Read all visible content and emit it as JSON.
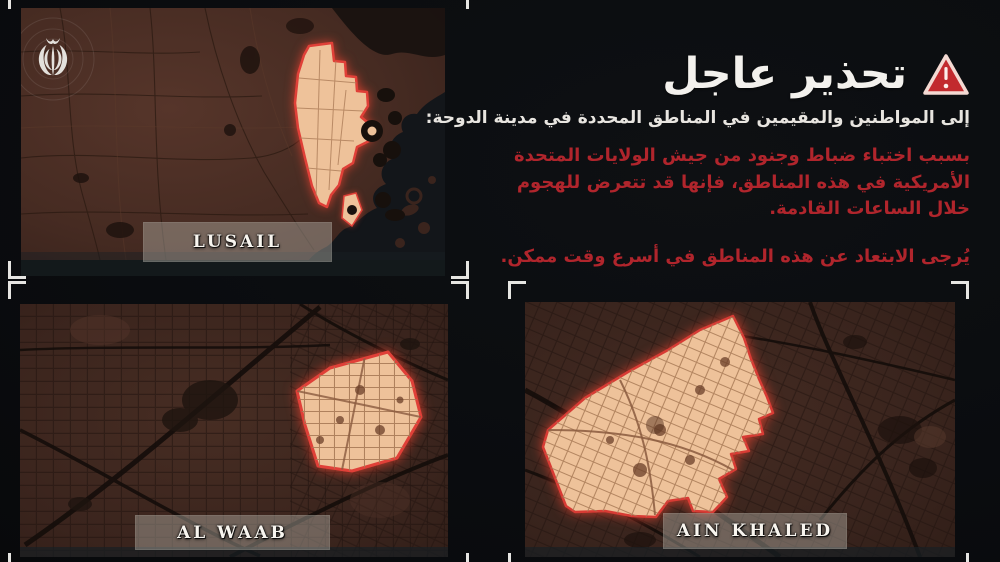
{
  "canvas": {
    "width": 1000,
    "height": 562
  },
  "colors": {
    "background": "#0a0c0f",
    "alert_red_text": "#b0252c",
    "triangle_fill": "#c22a2e",
    "triangle_border": "#f4d9d2",
    "highlight_fill": "#eec29a",
    "highlight_stroke": "#e04038",
    "crop_mark": "#e6e5e2",
    "label_background": "rgba(185,183,174,0.42)",
    "heading_white": "#f3f1ed"
  },
  "icons": {
    "warning": "warning-triangle-icon",
    "emblem": "iran-emblem-icon"
  },
  "warning": {
    "title": "تحذير عاجل",
    "subtitle": "إلى المواطنين والمقيمين في المناطق المحددة في مدينة الدوحة:",
    "body": "بسبب اختباء ضباط وجنود من جيش الولايات المتحدة الأمريكية في هذه المناطق، فإنها قد تتعرض للهجوم خلال الساعات القادمة.",
    "advice": "يُرجى الابتعاد عن هذه المناطق في أسرع وقت ممكن."
  },
  "panels": [
    {
      "id": "lusail",
      "label": "LUSAIL"
    },
    {
      "id": "alwaab",
      "label": "AL WAAB"
    },
    {
      "id": "ainkhaled",
      "label": "AIN KHALED"
    }
  ]
}
